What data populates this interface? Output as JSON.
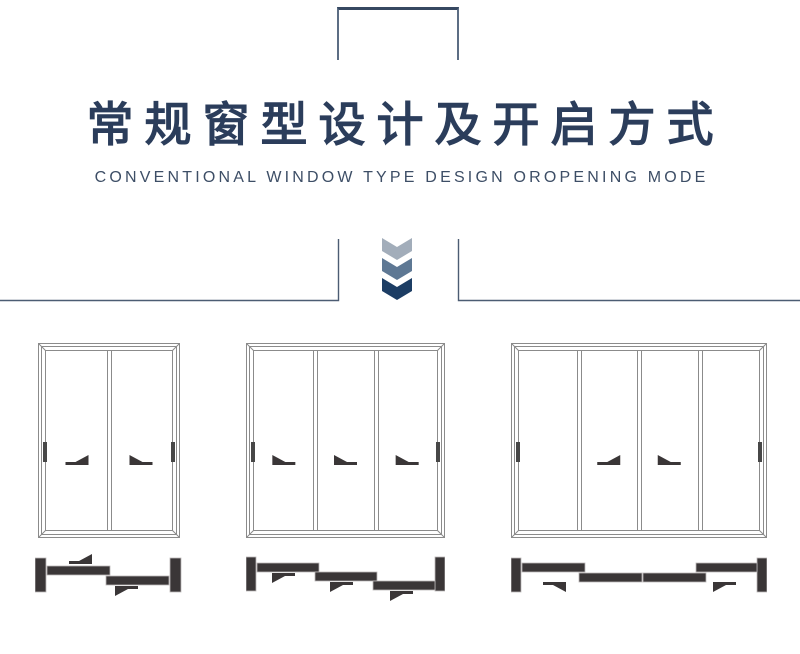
{
  "header": {
    "title": "常规窗型设计及开启方式",
    "subtitle": "CONVENTIONAL WINDOW TYPE DESIGN OROPENING MODE"
  },
  "colors": {
    "title": "#2b3d5b",
    "subtitle": "#3d4e66",
    "bracket": "#364861",
    "divider_line": "#4c5c73",
    "window_line": "#8b8b8b",
    "handle": "#474747",
    "dark_glyph": "#3a3637",
    "chevrons": [
      "#a2adba",
      "#5e7894",
      "#1c3d64"
    ]
  },
  "windows": [
    {
      "id": "two-panel-slider",
      "panels": 2,
      "width": 142,
      "height": 195,
      "arrows": [
        {
          "panel": 0,
          "dir": "right"
        },
        {
          "panel": 1,
          "dir": "left"
        }
      ],
      "plan": {
        "width": 147,
        "height": 52,
        "caps": [
          {
            "x": 0,
            "y": 6,
            "w": 11,
            "h": 34
          },
          {
            "x": 135,
            "y": 6,
            "w": 11,
            "h": 34
          }
        ],
        "bars": [
          {
            "x": 12,
            "y": 14,
            "w": 63,
            "h": 9
          },
          {
            "x": 71,
            "y": 24,
            "w": 63,
            "h": 9
          }
        ],
        "arrows": [
          {
            "x": 34,
            "y": 2,
            "dir": "right",
            "head": "up"
          },
          {
            "x": 80,
            "y": 34,
            "dir": "left",
            "head": "down"
          }
        ]
      }
    },
    {
      "id": "three-panel-slider",
      "panels": 3,
      "width": 199,
      "height": 195,
      "arrows": [
        {
          "panel": 0,
          "dir": "left"
        },
        {
          "panel": 1,
          "dir": "left"
        },
        {
          "panel": 2,
          "dir": "left"
        }
      ],
      "plan": {
        "width": 199,
        "height": 52,
        "caps": [
          {
            "x": 0,
            "y": 6,
            "w": 10,
            "h": 34
          },
          {
            "x": 189,
            "y": 6,
            "w": 10,
            "h": 34
          }
        ],
        "bars": [
          {
            "x": 11,
            "y": 12,
            "w": 62,
            "h": 9
          },
          {
            "x": 69,
            "y": 21,
            "w": 62,
            "h": 9
          },
          {
            "x": 127,
            "y": 30,
            "w": 62,
            "h": 9
          }
        ],
        "arrows": [
          {
            "x": 26,
            "y": 22,
            "dir": "left",
            "head": "down"
          },
          {
            "x": 84,
            "y": 31,
            "dir": "left",
            "head": "down"
          },
          {
            "x": 144,
            "y": 40,
            "dir": "left",
            "head": "down"
          }
        ]
      }
    },
    {
      "id": "four-panel-slider",
      "panels": 4,
      "width": 256,
      "height": 195,
      "arrows": [
        {
          "panel": 1,
          "dir": "right"
        },
        {
          "panel": 2,
          "dir": "left"
        }
      ],
      "plan": {
        "width": 256,
        "height": 52,
        "caps": [
          {
            "x": 0,
            "y": 7,
            "w": 10,
            "h": 34
          },
          {
            "x": 246,
            "y": 7,
            "w": 10,
            "h": 34
          }
        ],
        "bars": [
          {
            "x": 11,
            "y": 12,
            "w": 63,
            "h": 9
          },
          {
            "x": 68,
            "y": 22,
            "w": 63,
            "h": 9
          },
          {
            "x": 132,
            "y": 22,
            "w": 63,
            "h": 9
          },
          {
            "x": 185,
            "y": 12,
            "w": 61,
            "h": 9
          }
        ],
        "arrows": [
          {
            "x": 32,
            "y": 31,
            "dir": "right",
            "head": "down"
          },
          {
            "x": 202,
            "y": 31,
            "dir": "left",
            "head": "down"
          }
        ]
      }
    }
  ]
}
